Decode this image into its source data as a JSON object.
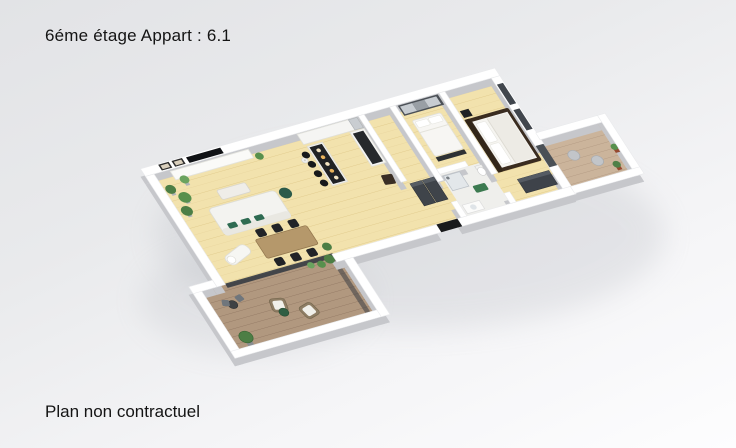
{
  "header": {
    "title": "6éme étage Appart : 6.1"
  },
  "footer": {
    "disclaimer": "Plan non contractuel"
  },
  "palette": {
    "background_top": "#e2e3e6",
    "background_bottom": "#fdfdfe",
    "wall_top": "#ffffff",
    "wall_side": "#c6c7cb",
    "indoor_floor_wood": "#f2e2ad",
    "terrace_deck_wood": "#b1987f",
    "balcony_deck_wood": "#cbb49b",
    "bathroom_floor": "#efefec",
    "glass_frame_dark": "#3a3e44",
    "furniture_dark": "#212327",
    "sofa_white": "#f3f3f0",
    "dining_table_wood": "#b5986b",
    "bed_frame_dark_wood": "#3a2c1f",
    "wardrobe_gray": "#4b5056",
    "plant_green": "#4c7e45",
    "plant_pot_terracotta": "#96492f",
    "cushion_green": "#2e6b52"
  },
  "scene": {
    "type": "3d-floor-plan-render",
    "rooms": [
      "living-dining-room",
      "kitchen",
      "entrance-hall",
      "bedroom-1",
      "bathroom",
      "bedroom-2",
      "terrace",
      "balcony"
    ]
  }
}
